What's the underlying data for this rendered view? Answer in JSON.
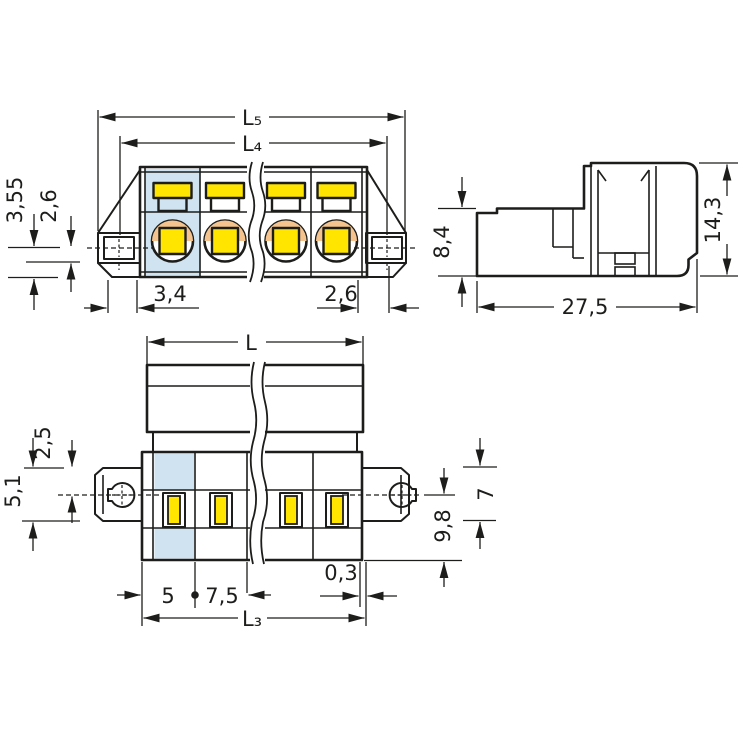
{
  "drawing": {
    "type": "technical-dimensional-drawing",
    "colors": {
      "housing_gray": "#b4b6b8",
      "first_pole_highlight_blue": "#cfe3f0",
      "clamp_yellow": "#ffe500",
      "contact_peach": "#f5c48e",
      "line_color": "#1d1d1b",
      "hole_fill": "#eceded"
    },
    "top_view": {
      "dims": {
        "l5": "L₅",
        "l4": "L₄",
        "left_outer": "3,55",
        "left_inner": "2,6",
        "bottom_left": "3,4",
        "bottom_right": "2,6"
      }
    },
    "side_view": {
      "dims": {
        "height_left": "8,4",
        "height_right": "14,3",
        "width": "27,5"
      }
    },
    "front_view": {
      "dims": {
        "overall": "L",
        "flange_top_offset": "2,5",
        "flange_height": "5,1",
        "right_outer": "7",
        "right_inner": "9,8",
        "first_pitch": "5",
        "pole_pitch": "7,5",
        "edge_offset": "0,3",
        "lower_span": "L₃"
      }
    }
  }
}
